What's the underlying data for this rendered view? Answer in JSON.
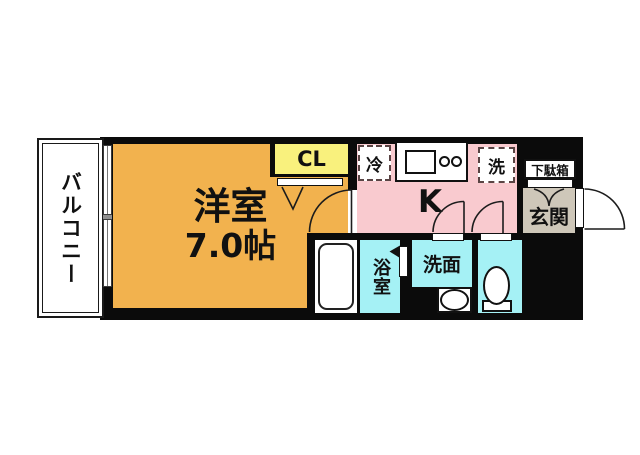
{
  "floorplan": {
    "balcony": {
      "label": "バルコニー"
    },
    "living_room": {
      "label": "洋室",
      "size": "7.0帖"
    },
    "closet": {
      "label": "CL"
    },
    "kitchen": {
      "label": "K"
    },
    "refrigerator": {
      "label": "冷"
    },
    "washer": {
      "label": "洗"
    },
    "shoe_cabinet": {
      "label": "下駄箱"
    },
    "entrance": {
      "label": "玄関"
    },
    "bathroom": {
      "label": "浴室"
    },
    "washroom": {
      "label": "洗面"
    }
  },
  "colors": {
    "wall": "#0b0b0b",
    "living_room": "#F2B24E",
    "closet": "#F9F17D",
    "kitchen": "#F9CACF",
    "wet_area": "#A5F1F5",
    "entrance": "#CEC7B9",
    "fixture_dash": "#5a4444"
  }
}
